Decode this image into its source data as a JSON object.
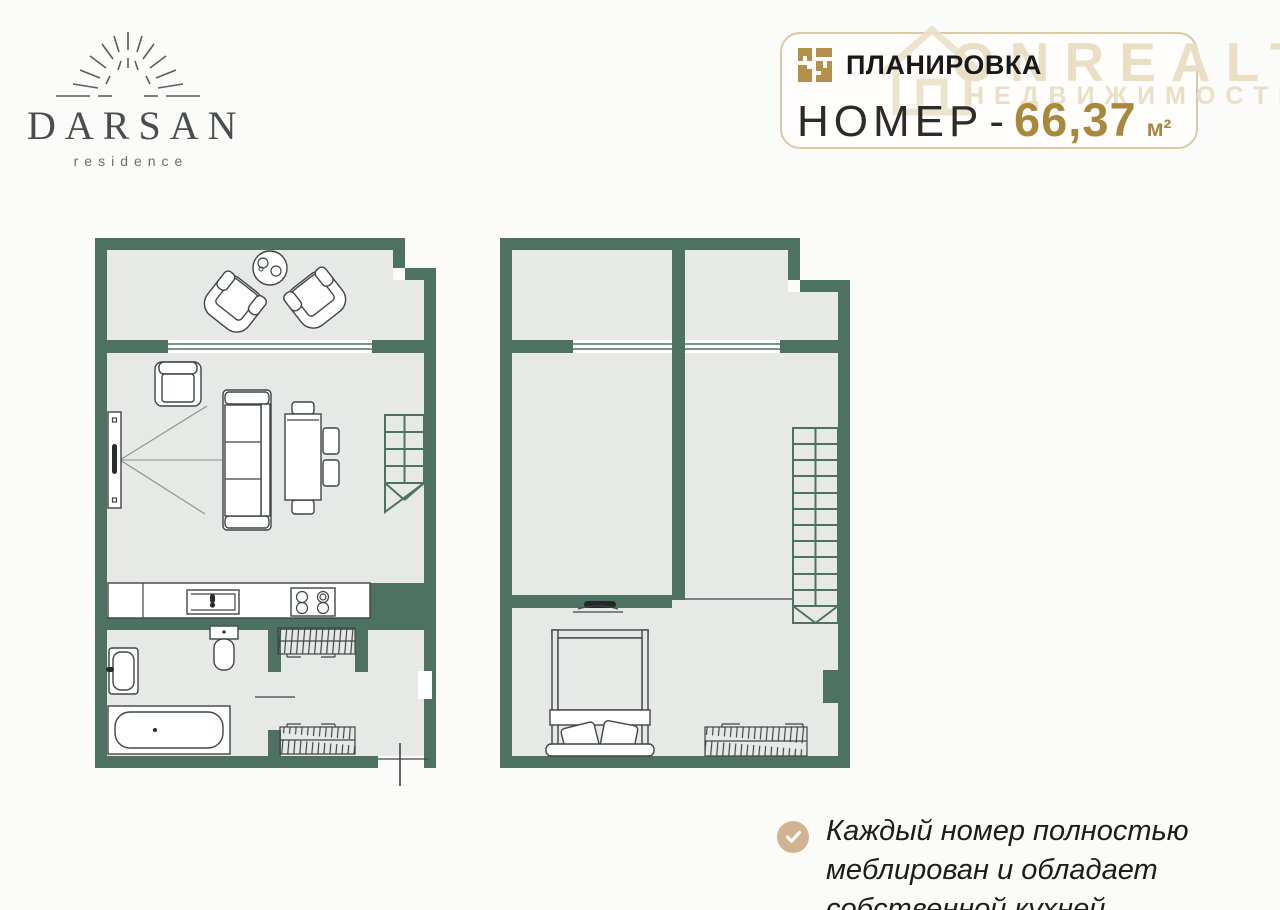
{
  "colors": {
    "wall": "#4e7261",
    "floor": "#e6e9e5",
    "line": "#3f4549",
    "gold": "#a8883d",
    "gold_icon": "#b3914a",
    "box_border": "#d9c9a7",
    "watermark": "#eadfc5",
    "check_bg": "#d2b391",
    "text": "#1c1c1c",
    "logo": "#4a4c4e",
    "bg": "#fbfbf9"
  },
  "logo": {
    "name": "DARSAN",
    "subtitle": "residence"
  },
  "header": {
    "title": "ПЛАНИРОВКА",
    "area_label": "НОМЕР",
    "dash": "-",
    "area_value": "66,37",
    "area_unit": "м²"
  },
  "watermark": {
    "brand": "ONREALT",
    "subtitle": "НЕДВИЖИМОСТЬ"
  },
  "note": {
    "text": "Каждый номер полностью меблирован и обладает собственной кухней"
  }
}
